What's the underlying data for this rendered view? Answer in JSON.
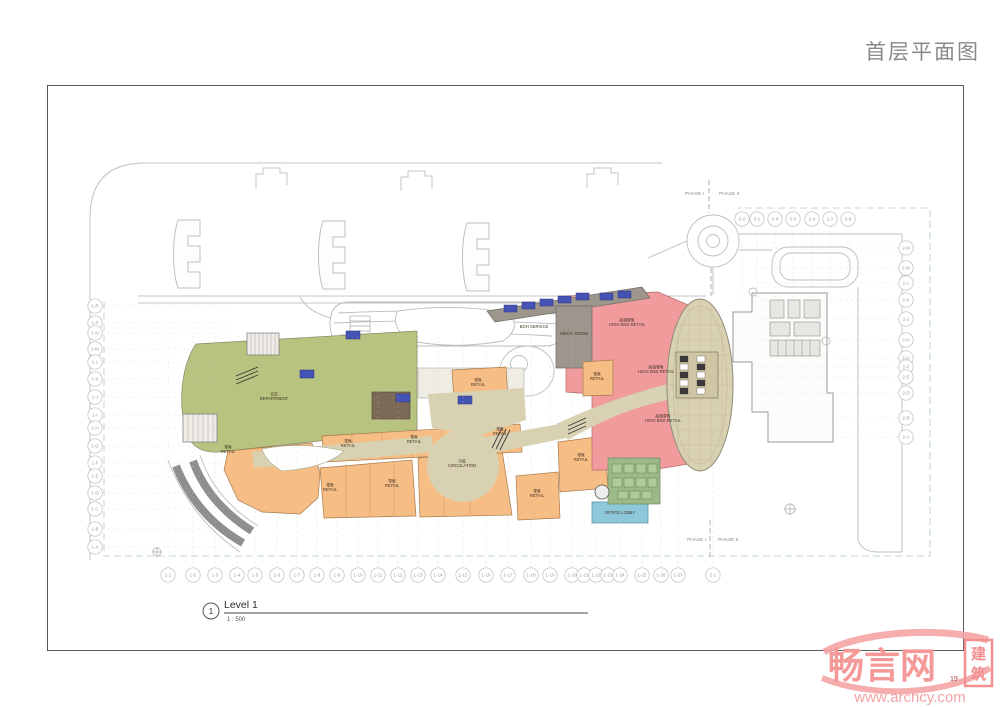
{
  "page": {
    "title": "首层平面图",
    "page_number": "19"
  },
  "caption": {
    "view_number": "1",
    "view_name": "Level 1",
    "scale": "1 : 500"
  },
  "watermark": {
    "brand": "畅言网",
    "seal_top": "建",
    "seal_bottom": "筑",
    "url": "www.archcy.com",
    "color": "#f49898"
  },
  "colors": {
    "department": "#b7c37f",
    "retail": "#f6bd85",
    "high_end_retail": "#f19b9d",
    "circulation": "#d8d1b2",
    "office_lobby": "#8cc8da",
    "office_core": "#9db98a",
    "mech": "#9d968d",
    "core_blue": "#4553b4"
  },
  "plan": {
    "phase_labels": [
      {
        "label": "PHASE I",
        "x": 704,
        "y": 195,
        "anchor": "end"
      },
      {
        "label": "PHASE II",
        "x": 719,
        "y": 195,
        "anchor": "start"
      },
      {
        "label": "PHASE I",
        "x": 706,
        "y": 541,
        "anchor": "end"
      },
      {
        "label": "PHASE II",
        "x": 718,
        "y": 541,
        "anchor": "start"
      }
    ],
    "rooms": [
      {
        "zh": "百货",
        "label": "DEPARTMENT",
        "x": 274,
        "y": 400
      },
      {
        "zh": "零售",
        "label": "RETAIL",
        "x": 228,
        "y": 453
      },
      {
        "zh": "零售",
        "label": "RETAIL",
        "x": 330,
        "y": 491
      },
      {
        "zh": "零售",
        "label": "RETAIL",
        "x": 392,
        "y": 487
      },
      {
        "zh": "零售",
        "label": "RETAIL",
        "x": 348,
        "y": 447
      },
      {
        "zh": "零售",
        "label": "RETAIL",
        "x": 414,
        "y": 443
      },
      {
        "zh": "零售",
        "label": "RETAIL",
        "x": 478,
        "y": 386
      },
      {
        "zh": "零售",
        "label": "RETAIL",
        "x": 500,
        "y": 435
      },
      {
        "zh": "零售",
        "label": "RETAIL",
        "x": 537,
        "y": 497
      },
      {
        "zh": "零售",
        "label": "RETAIL",
        "x": 581,
        "y": 461
      },
      {
        "zh": "零售",
        "label": "RETAIL",
        "x": 597,
        "y": 380
      },
      {
        "zh": "高端零售",
        "label": "HIGH END RETAIL",
        "x": 627,
        "y": 326
      },
      {
        "zh": "高端零售",
        "label": "HIGH END RETAIL",
        "x": 656,
        "y": 373
      },
      {
        "zh": "高端零售",
        "label": "HIGH END RETAIL",
        "x": 663,
        "y": 422
      },
      {
        "zh": "中庭",
        "label": "CIRCULATION",
        "x": 462,
        "y": 467
      },
      {
        "zh": "",
        "label": "BOH SERVICE",
        "x": 534,
        "y": 328
      },
      {
        "zh": "",
        "label": "MECH. ROOM",
        "x": 574,
        "y": 335
      },
      {
        "zh": "",
        "label": "OFFICE LOBBY",
        "x": 620,
        "y": 514
      }
    ],
    "grid": {
      "bottom": {
        "y": 575,
        "labels": [
          "1-1",
          "1-2",
          "1-3",
          "1-4",
          "1-5",
          "1-6",
          "1-7",
          "1-8",
          "1-9",
          "1-10",
          "1-11",
          "1-12",
          "1-13",
          "1-14",
          "1-15",
          "1-16",
          "1-17",
          "1-18",
          "1-19",
          "1-20",
          "1-21",
          "1-22",
          "1-23",
          "1-24",
          "1-25",
          "1-26",
          "1-27",
          "2-1"
        ],
        "xs": [
          168,
          193,
          215,
          237,
          255,
          277,
          297,
          317,
          337,
          358,
          378,
          398,
          418,
          438,
          463,
          486,
          508,
          531,
          550,
          572,
          584,
          596,
          608,
          620,
          642,
          661,
          678,
          713
        ]
      },
      "top": {
        "y": 219,
        "labels": [
          "3-2",
          "3-1",
          "2-4",
          "2-5",
          "2-6",
          "2-7",
          "2-8"
        ],
        "xs": [
          742,
          757,
          775,
          793,
          812,
          830,
          848
        ]
      },
      "left": {
        "x": 95,
        "labels": [
          "1-R",
          "1-P",
          "1-N",
          "1-M",
          "1-L",
          "1-K",
          "1-J",
          "1-I",
          "1-H",
          "1-G",
          "1-F",
          "1-E",
          "1-D",
          "1-C",
          "1-B",
          "1-A"
        ],
        "ys": [
          306,
          323,
          333,
          349,
          362,
          379,
          397,
          415,
          428,
          446,
          463,
          476,
          493,
          509,
          529,
          547
        ]
      },
      "right": {
        "x": 906,
        "labels": [
          "2-N",
          "2-M",
          "2-L",
          "2-K",
          "2-J",
          "2-H",
          "2-G",
          "2-F",
          "2-E",
          "2-D",
          "2-B",
          "2-A"
        ],
        "ys": [
          248,
          268,
          283,
          300,
          319,
          340,
          358,
          367,
          377,
          393,
          418,
          437
        ]
      }
    }
  }
}
